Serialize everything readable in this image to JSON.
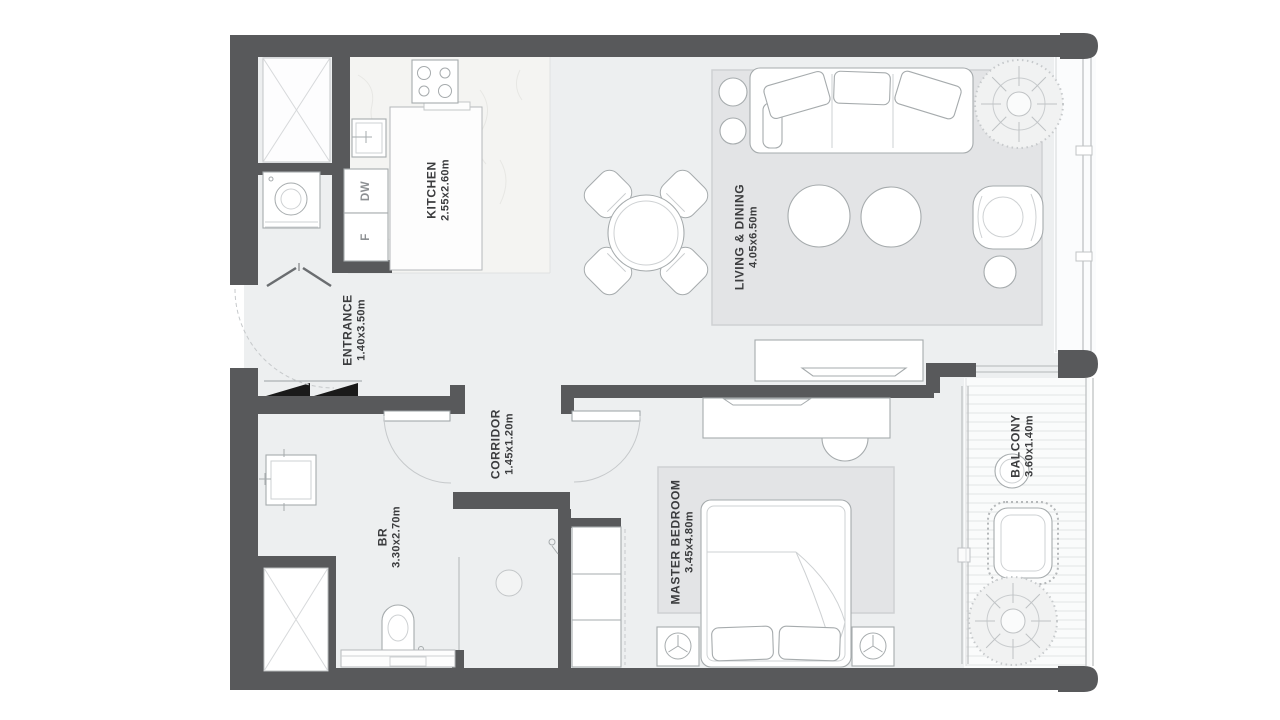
{
  "plan": {
    "rooms": {
      "kitchen": {
        "name": "KITCHEN",
        "dims": "2.55x2.60m"
      },
      "living_dining": {
        "name": "LIVING & DINING",
        "dims": "4.05x6.50m"
      },
      "entrance": {
        "name": "ENTRANCE",
        "dims": "1.40x3.50m"
      },
      "corridor": {
        "name": "CORRIDOR",
        "dims": "1.45x1.20m"
      },
      "bathroom": {
        "name": "BR",
        "dims": "3.30x2.70m"
      },
      "master_bedroom": {
        "name": "MASTER BEDROOM",
        "dims": "3.45x4.80m"
      },
      "balcony": {
        "name": "BALCONY",
        "dims": "3.60x1.40m"
      }
    },
    "appliances": {
      "dishwasher": "DW",
      "fridge": "F"
    },
    "colors": {
      "wall": "#58595b",
      "floor": "#edeff0",
      "rug": "#e3e4e6",
      "furniture_line": "#a6abad",
      "closet_door_black": "#1a1a1a"
    }
  }
}
